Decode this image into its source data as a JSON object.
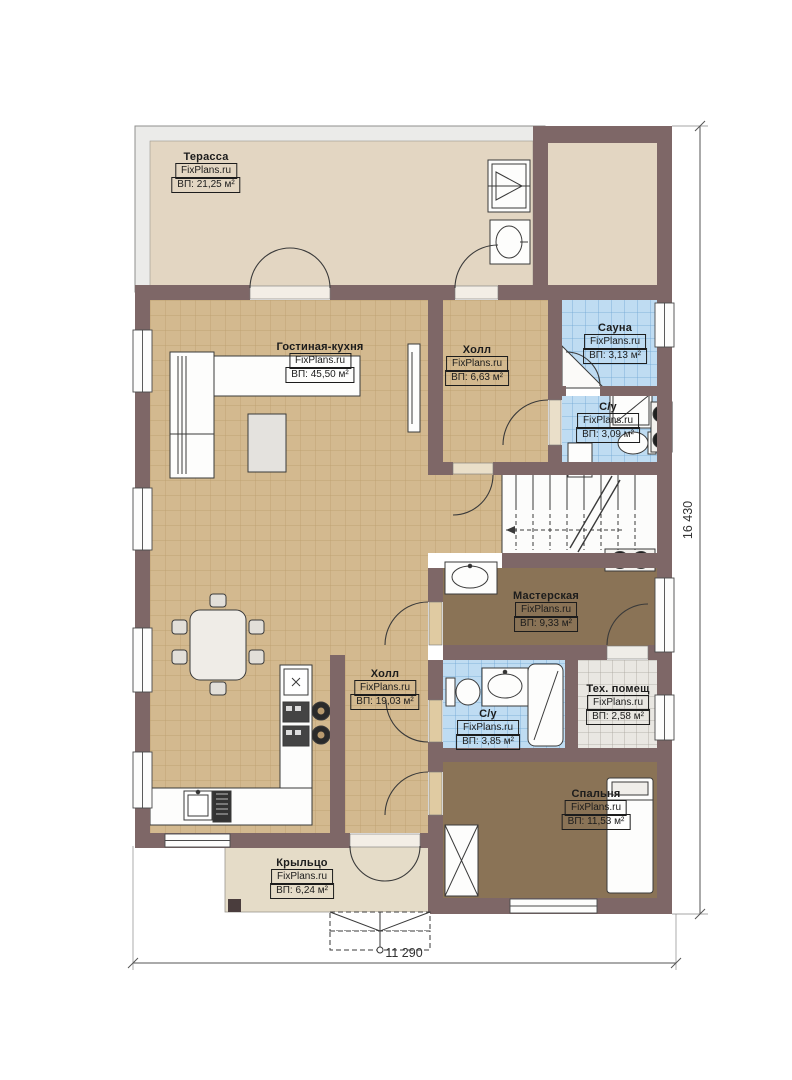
{
  "plan": {
    "rooms": {
      "terrace": {
        "name": "Терасса",
        "brand": "FixPlans.ru",
        "area": "ВП: 21,25 м²"
      },
      "living": {
        "name": "Гостиная-кухня",
        "brand": "FixPlans.ru",
        "area": "ВП: 45,50 м²"
      },
      "hall_top": {
        "name": "Холл",
        "brand": "FixPlans.ru",
        "area": "ВП: 6,63 м²"
      },
      "sauna": {
        "name": "Сауна",
        "brand": "FixPlans.ru",
        "area": "ВП: 3,13 м²"
      },
      "wc_top": {
        "name": "С/у",
        "brand": "FixPlans.ru",
        "area": "ВП: 3,09 м²"
      },
      "workshop": {
        "name": "Мастерская",
        "brand": "FixPlans.ru",
        "area": "ВП: 9,33 м²"
      },
      "hall_bottom": {
        "name": "Холл",
        "brand": "FixPlans.ru",
        "area": "ВП: 19,03 м²"
      },
      "wc_bottom": {
        "name": "С/у",
        "brand": "FixPlans.ru",
        "area": "ВП: 3,85 м²"
      },
      "tech": {
        "name": "Тех. помещ",
        "brand": "FixPlans.ru",
        "area": "ВП: 2,58 м²"
      },
      "bedroom": {
        "name": "Спальня",
        "brand": "FixPlans.ru",
        "area": "ВП: 11,53 м²"
      },
      "porch": {
        "name": "Крыльцо",
        "brand": "FixPlans.ru",
        "area": "ВП: 6,24 м²"
      }
    },
    "dimensions": {
      "height": "16 430",
      "width": "11 290"
    },
    "colors": {
      "wall": "#7E6767",
      "tile_beige": "#D3B98F",
      "tile_blue": "#BFDCF2",
      "floor_brown": "#8A7356",
      "terrace": "#E3D6C2",
      "porch": "#E5DCC8"
    }
  }
}
